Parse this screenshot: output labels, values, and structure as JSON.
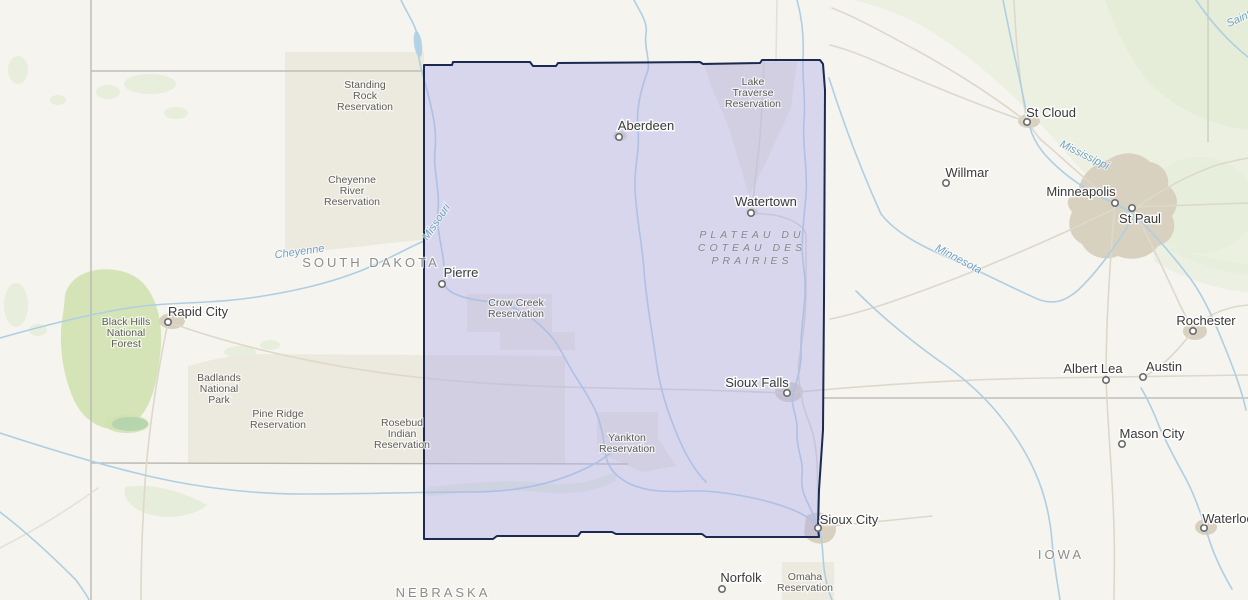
{
  "map": {
    "selection": {
      "fill": "rgba(173,171,231,0.42)",
      "stroke": "#1b2a52"
    },
    "colors": {
      "land": "#f5f4ef",
      "water": "#aecfe3",
      "road": "#ded8ca",
      "border": "#b8b5af",
      "urban": "#d8d1c0",
      "green": "#e4ecd7",
      "green_dark": "#cfe0ad",
      "res": "#ece9de"
    },
    "cities": [
      {
        "name": "Aberdeen",
        "label": {
          "x": 646,
          "y": 130
        },
        "marker": {
          "x": 619,
          "y": 137
        }
      },
      {
        "name": "Watertown",
        "label": {
          "x": 766,
          "y": 206
        },
        "marker": {
          "x": 751,
          "y": 213
        }
      },
      {
        "name": "Pierre",
        "label": {
          "x": 461,
          "y": 277
        },
        "marker": {
          "x": 442,
          "y": 284
        }
      },
      {
        "name": "Sioux Falls",
        "label": {
          "x": 757,
          "y": 387
        },
        "marker": {
          "x": 787,
          "y": 393
        }
      },
      {
        "name": "Sioux City",
        "label": {
          "x": 849,
          "y": 524
        },
        "marker": {
          "x": 818,
          "y": 528
        }
      },
      {
        "name": "Rapid City",
        "label": {
          "x": 198,
          "y": 316
        },
        "marker": {
          "x": 168,
          "y": 322
        }
      },
      {
        "name": "St Cloud",
        "label": {
          "x": 1051,
          "y": 117
        },
        "marker": {
          "x": 1027,
          "y": 122
        }
      },
      {
        "name": "Willmar",
        "label": {
          "x": 967,
          "y": 177
        },
        "marker": {
          "x": 946,
          "y": 183
        }
      },
      {
        "name": "Minneapolis",
        "label": {
          "x": 1081,
          "y": 196
        },
        "marker": {
          "x": 1115,
          "y": 203
        }
      },
      {
        "name": "St Paul",
        "label": {
          "x": 1140,
          "y": 223
        },
        "marker": {
          "x": 1132,
          "y": 208
        }
      },
      {
        "name": "Rochester",
        "label": {
          "x": 1206,
          "y": 325
        },
        "marker": {
          "x": 1193,
          "y": 331
        }
      },
      {
        "name": "Albert Lea",
        "label": {
          "x": 1093,
          "y": 373
        },
        "marker": {
          "x": 1106,
          "y": 380
        }
      },
      {
        "name": "Austin",
        "label": {
          "x": 1164,
          "y": 371
        },
        "marker": {
          "x": 1143,
          "y": 377
        }
      },
      {
        "name": "Mason City",
        "label": {
          "x": 1152,
          "y": 438
        },
        "marker": {
          "x": 1122,
          "y": 444
        }
      },
      {
        "name": "Waterloo",
        "label": {
          "x": 1228,
          "y": 523
        },
        "marker": {
          "x": 1204,
          "y": 528
        }
      },
      {
        "name": "Norfolk",
        "label": {
          "x": 741,
          "y": 582
        },
        "marker": {
          "x": 722,
          "y": 589
        }
      }
    ],
    "area_labels": [
      {
        "id": "standing-rock-reservation",
        "lines": [
          "Standing",
          "Rock",
          "Reservation"
        ],
        "x": 365,
        "y": 88,
        "cls": "area-label"
      },
      {
        "id": "cheyenne-river-reservation",
        "lines": [
          "Cheyenne",
          "River",
          "Reservation"
        ],
        "x": 352,
        "y": 183,
        "cls": "area-label"
      },
      {
        "id": "lake-traverse-reservation",
        "lines": [
          "Lake",
          "Traverse",
          "Reservation"
        ],
        "x": 753,
        "y": 85,
        "cls": "area-label"
      },
      {
        "id": "crow-creek-reservation",
        "lines": [
          "Crow Creek",
          "Reservation"
        ],
        "x": 516,
        "y": 306,
        "cls": "area-label"
      },
      {
        "id": "pine-ridge-reservation",
        "lines": [
          "Pine Ridge",
          "Reservation"
        ],
        "x": 278,
        "y": 417,
        "cls": "area-label"
      },
      {
        "id": "rosebud-indian-reservation",
        "lines": [
          "Rosebud",
          "Indian",
          "Reservation"
        ],
        "x": 402,
        "y": 426,
        "cls": "area-label"
      },
      {
        "id": "yankton-reservation",
        "lines": [
          "Yankton",
          "Reservation"
        ],
        "x": 627,
        "y": 441,
        "cls": "area-label"
      },
      {
        "id": "omaha-reservation",
        "lines": [
          "Omaha",
          "Reservation"
        ],
        "x": 805,
        "y": 580,
        "cls": "area-label"
      },
      {
        "id": "black-hills-national-forest",
        "lines": [
          "Black Hills",
          "National",
          "Forest"
        ],
        "x": 126,
        "y": 325,
        "cls": "area-label"
      },
      {
        "id": "badlands-national-park",
        "lines": [
          "Badlands",
          "National",
          "Park"
        ],
        "x": 219,
        "y": 381,
        "cls": "area-label"
      },
      {
        "id": "plateau-du-coteau",
        "lines": [
          "PLATEAU DU",
          "COTEAU DES",
          "PRAIRIES"
        ],
        "x": 752,
        "y": 238,
        "cls": "plateau-label"
      }
    ],
    "state_labels": [
      {
        "text": "SOUTH DAKOTA",
        "x": 371,
        "y": 267
      },
      {
        "text": "NEBRASKA",
        "x": 443,
        "y": 597
      },
      {
        "text": "IOWA",
        "x": 1061,
        "y": 559
      }
    ],
    "river_labels": [
      {
        "text": "Cheyenne",
        "x": 300,
        "y": 255,
        "rotate": -8
      },
      {
        "text": "Missouri",
        "x": 439,
        "y": 224,
        "rotate": -56
      },
      {
        "text": "Minnesota",
        "x": 957,
        "y": 262,
        "rotate": 28
      },
      {
        "text": "Mississippi",
        "x": 1083,
        "y": 158,
        "rotate": 26
      },
      {
        "text": "Saint",
        "x": 1240,
        "y": 22,
        "rotate": -25
      }
    ]
  }
}
